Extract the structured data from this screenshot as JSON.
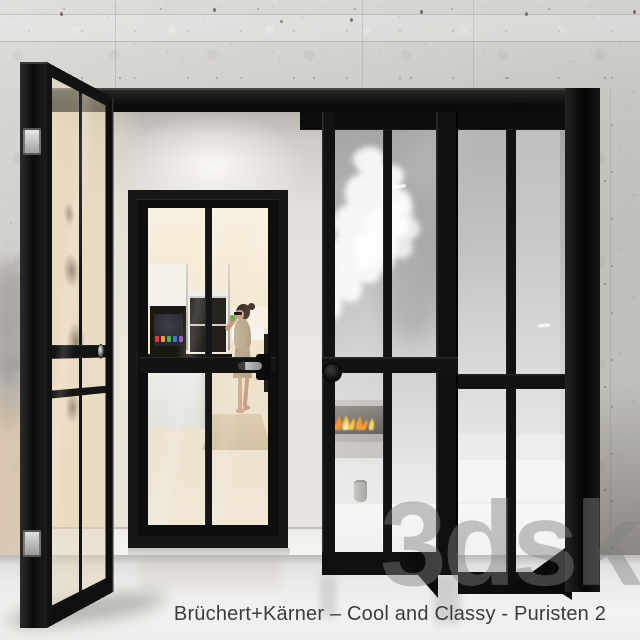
{
  "caption": {
    "text": "Brüchert+Kärner – Cool and Classy - Puristen 2"
  },
  "watermark": {
    "text": "3dsky"
  },
  "palette": {
    "frame_black": "#121212",
    "concrete_gray": "#cdcbc7",
    "interior_warm_white": "#f3e7d2",
    "floor_white": "#f0efed",
    "frosted_glass_top": "#a2a3a2",
    "frosted_glass_bottom": "#f2f2f1",
    "flame_orange": "#ff8c1a",
    "flame_yellow": "#ffc23d",
    "dress_beige": "#b9a98c",
    "skin_tone": "#c79d80",
    "hair_brown": "#3a2a1e",
    "drink_green": "#6fa84c",
    "chrome": "#c4c4c4",
    "tv_icons": [
      "#e23b3b",
      "#f0a030",
      "#57b24a",
      "#3a7bd5",
      "#9b59b6"
    ]
  }
}
